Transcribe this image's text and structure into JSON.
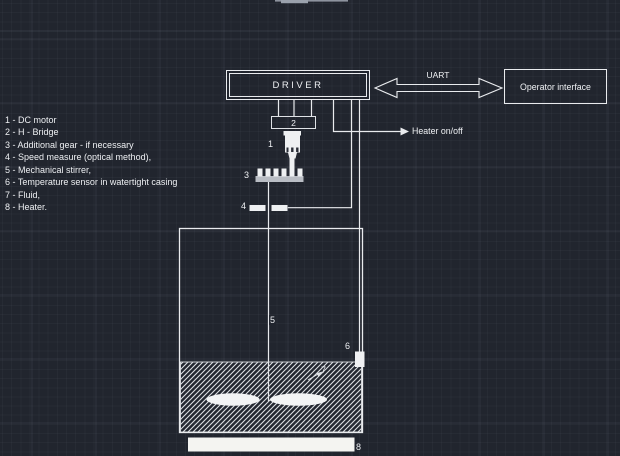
{
  "window": {
    "app_context": "CAD drawing canvas",
    "colors": {
      "background": "#21252e",
      "line": "#e9ebee",
      "grid_major": "rgba(170,180,200,0.10)",
      "grid_minor": "rgba(170,180,200,0.04)",
      "fill_white": "#f2f3f4",
      "gear_base_gray": "#b9bdc4"
    }
  },
  "blocks": {
    "driver_label": "DRIVER",
    "operator_label": "Operator interface",
    "uart_label": "UART",
    "heater_signal_label": "Heater on/off"
  },
  "labels": {
    "dc_motor": "1",
    "h_bridge": "2",
    "gear": "3",
    "speed": "4",
    "stirrer": "5",
    "temp_sensor": "6",
    "fluid": "7",
    "heater": "8"
  },
  "legend": {
    "items": [
      "1 - DC motor",
      "2 - H - Bridge",
      "3 - Additional gear - if necessary",
      "4 - Speed measure (optical method),",
      "5 - Mechanical stirrer,",
      "6 - Temperature sensor in watertight casing",
      "7 - Fluid,",
      "8 - Heater."
    ]
  }
}
